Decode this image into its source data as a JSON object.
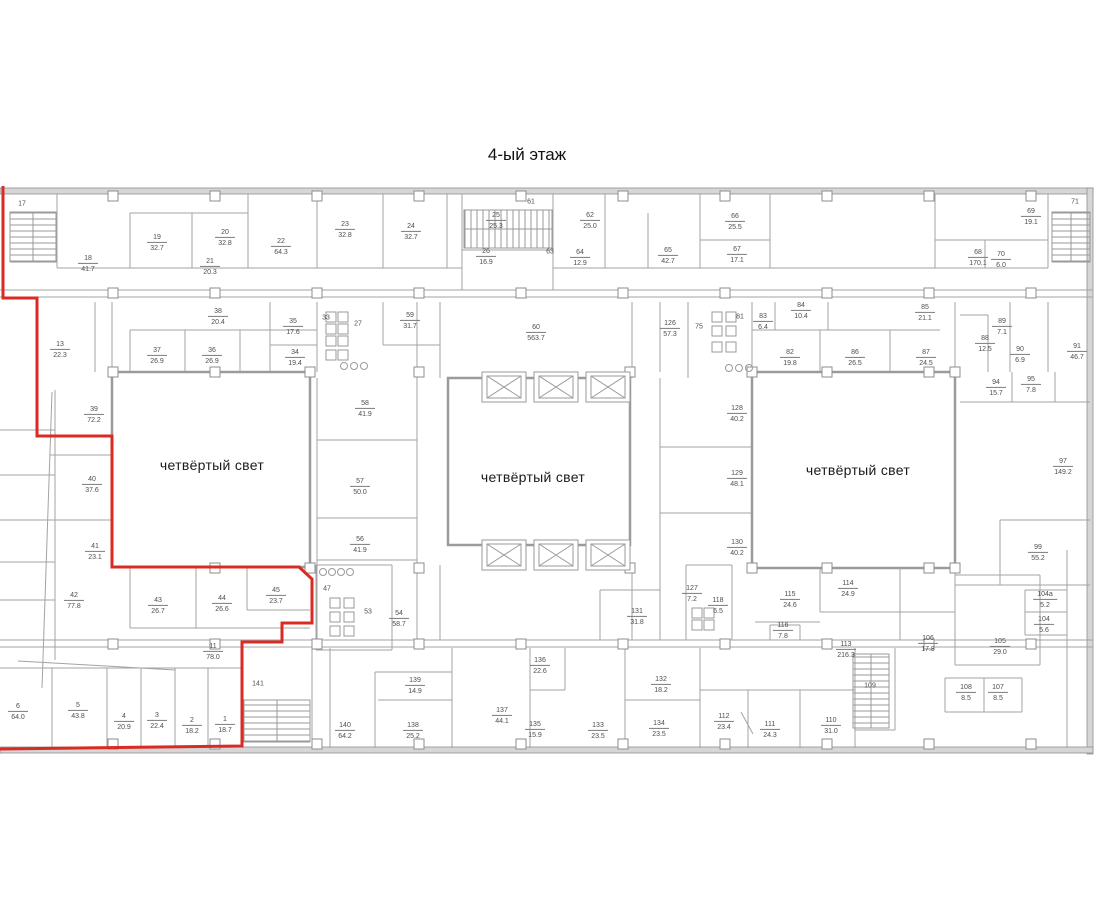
{
  "title": "4-ый этаж",
  "atrium_label": "четвёртый свет",
  "colors": {
    "wall": "#a3a3a3",
    "outer_wall_fill": "#d6d6d6",
    "outer_wall_stroke": "#8f8f8f",
    "atrium_wall": "#9b9b9b",
    "red_outline": "#d92b23",
    "label_text": "#4e4e4e",
    "title_text": "#111111"
  },
  "atria": [
    {
      "label_x": 212,
      "label_y": 465
    },
    {
      "label_x": 533,
      "label_y": 477
    },
    {
      "label_x": 858,
      "label_y": 470
    }
  ],
  "red_outline": {
    "points": [
      [
        3,
        186
      ],
      [
        3,
        298
      ],
      [
        37,
        298
      ],
      [
        37,
        436
      ],
      [
        112,
        436
      ],
      [
        112,
        567
      ],
      [
        299,
        567
      ],
      [
        312,
        579
      ],
      [
        312,
        623
      ],
      [
        282,
        623
      ],
      [
        282,
        642
      ],
      [
        242,
        642
      ],
      [
        242,
        746
      ],
      [
        0,
        749
      ]
    ]
  },
  "rooms": [
    {
      "n": "17",
      "a": "",
      "x": 22,
      "y": 204
    },
    {
      "n": "18",
      "a": "41.7",
      "x": 88,
      "y": 264
    },
    {
      "n": "19",
      "a": "32.7",
      "x": 157,
      "y": 243
    },
    {
      "n": "20",
      "a": "32.8",
      "x": 225,
      "y": 238
    },
    {
      "n": "21",
      "a": "20.3",
      "x": 210,
      "y": 267
    },
    {
      "n": "22",
      "a": "64.3",
      "x": 281,
      "y": 247
    },
    {
      "n": "23",
      "a": "32.8",
      "x": 345,
      "y": 230
    },
    {
      "n": "24",
      "a": "32.7",
      "x": 411,
      "y": 232
    },
    {
      "n": "25",
      "a": "25.3",
      "x": 496,
      "y": 221
    },
    {
      "n": "61",
      "a": "",
      "x": 531,
      "y": 202
    },
    {
      "n": "26",
      "a": "16.9",
      "x": 486,
      "y": 257
    },
    {
      "n": "63",
      "a": "",
      "x": 550,
      "y": 252
    },
    {
      "n": "62",
      "a": "25.0",
      "x": 590,
      "y": 221
    },
    {
      "n": "64",
      "a": "12.9",
      "x": 580,
      "y": 258
    },
    {
      "n": "65",
      "a": "42.7",
      "x": 668,
      "y": 256
    },
    {
      "n": "66",
      "a": "25.5",
      "x": 735,
      "y": 222
    },
    {
      "n": "67",
      "a": "17.1",
      "x": 737,
      "y": 255
    },
    {
      "n": "68",
      "a": "170.1",
      "x": 978,
      "y": 258
    },
    {
      "n": "69",
      "a": "19.1",
      "x": 1031,
      "y": 217
    },
    {
      "n": "70",
      "a": "6.0",
      "x": 1001,
      "y": 260
    },
    {
      "n": "71",
      "a": "",
      "x": 1075,
      "y": 202
    },
    {
      "n": "13",
      "a": "22.3",
      "x": 60,
      "y": 350
    },
    {
      "n": "38",
      "a": "20.4",
      "x": 218,
      "y": 317
    },
    {
      "n": "37",
      "a": "26.9",
      "x": 157,
      "y": 356
    },
    {
      "n": "36",
      "a": "26.9",
      "x": 212,
      "y": 356
    },
    {
      "n": "35",
      "a": "17.6",
      "x": 293,
      "y": 327
    },
    {
      "n": "34",
      "a": "19.4",
      "x": 295,
      "y": 358
    },
    {
      "n": "33",
      "a": "",
      "x": 326,
      "y": 318
    },
    {
      "n": "27",
      "a": "",
      "x": 358,
      "y": 324
    },
    {
      "n": "59",
      "a": "31.7",
      "x": 410,
      "y": 321
    },
    {
      "n": "60",
      "a": "563.7",
      "x": 536,
      "y": 333
    },
    {
      "n": "126",
      "a": "57.3",
      "x": 670,
      "y": 329
    },
    {
      "n": "75",
      "a": "",
      "x": 699,
      "y": 327
    },
    {
      "n": "81",
      "a": "",
      "x": 740,
      "y": 317
    },
    {
      "n": "83",
      "a": "6.4",
      "x": 763,
      "y": 322
    },
    {
      "n": "84",
      "a": "10.4",
      "x": 801,
      "y": 311
    },
    {
      "n": "85",
      "a": "21.1",
      "x": 925,
      "y": 313
    },
    {
      "n": "82",
      "a": "19.8",
      "x": 790,
      "y": 358
    },
    {
      "n": "86",
      "a": "26.5",
      "x": 855,
      "y": 358
    },
    {
      "n": "87",
      "a": "24.5",
      "x": 926,
      "y": 358
    },
    {
      "n": "88",
      "a": "12.5",
      "x": 985,
      "y": 344
    },
    {
      "n": "89",
      "a": "7.1",
      "x": 1002,
      "y": 327
    },
    {
      "n": "90",
      "a": "6.9",
      "x": 1020,
      "y": 355
    },
    {
      "n": "91",
      "a": "46.7",
      "x": 1077,
      "y": 352
    },
    {
      "n": "94",
      "a": "15.7",
      "x": 996,
      "y": 388
    },
    {
      "n": "95",
      "a": "7.8",
      "x": 1031,
      "y": 385
    },
    {
      "n": "39",
      "a": "72.2",
      "x": 94,
      "y": 415
    },
    {
      "n": "40",
      "a": "37.6",
      "x": 92,
      "y": 485
    },
    {
      "n": "41",
      "a": "23.1",
      "x": 95,
      "y": 552
    },
    {
      "n": "58",
      "a": "41.9",
      "x": 365,
      "y": 409
    },
    {
      "n": "57",
      "a": "50.0",
      "x": 360,
      "y": 487
    },
    {
      "n": "56",
      "a": "41.9",
      "x": 360,
      "y": 545
    },
    {
      "n": "128",
      "a": "40.2",
      "x": 737,
      "y": 414
    },
    {
      "n": "129",
      "a": "48.1",
      "x": 737,
      "y": 479
    },
    {
      "n": "130",
      "a": "40.2",
      "x": 737,
      "y": 548
    },
    {
      "n": "97",
      "a": "149.2",
      "x": 1063,
      "y": 467
    },
    {
      "n": "99",
      "a": "55.2",
      "x": 1038,
      "y": 553
    },
    {
      "n": "42",
      "a": "77.8",
      "x": 74,
      "y": 601
    },
    {
      "n": "43",
      "a": "26.7",
      "x": 158,
      "y": 606
    },
    {
      "n": "44",
      "a": "26.6",
      "x": 222,
      "y": 604
    },
    {
      "n": "45",
      "a": "23.7",
      "x": 276,
      "y": 596
    },
    {
      "n": "47",
      "a": "",
      "x": 327,
      "y": 589
    },
    {
      "n": "53",
      "a": "",
      "x": 368,
      "y": 612
    },
    {
      "n": "54",
      "a": "58.7",
      "x": 399,
      "y": 619
    },
    {
      "n": "11",
      "a": "78.0",
      "x": 213,
      "y": 652
    },
    {
      "n": "131",
      "a": "31.8",
      "x": 637,
      "y": 617
    },
    {
      "n": "127",
      "a": "7.2",
      "x": 692,
      "y": 594
    },
    {
      "n": "118",
      "a": "6.5",
      "x": 718,
      "y": 606
    },
    {
      "n": "116",
      "a": "7.8",
      "x": 783,
      "y": 631
    },
    {
      "n": "115",
      "a": "24.6",
      "x": 790,
      "y": 600
    },
    {
      "n": "114",
      "a": "24.9",
      "x": 848,
      "y": 589
    },
    {
      "n": "113",
      "a": "216.3",
      "x": 846,
      "y": 650
    },
    {
      "n": "136",
      "a": "22.6",
      "x": 540,
      "y": 666
    },
    {
      "n": "132",
      "a": "18.2",
      "x": 661,
      "y": 685
    },
    {
      "n": "139",
      "a": "14.9",
      "x": 415,
      "y": 686
    },
    {
      "n": "141",
      "a": "",
      "x": 258,
      "y": 684
    },
    {
      "n": "109",
      "a": "",
      "x": 870,
      "y": 686
    },
    {
      "n": "106",
      "a": "17.8",
      "x": 928,
      "y": 644
    },
    {
      "n": "105",
      "a": "29.0",
      "x": 1000,
      "y": 647
    },
    {
      "n": "104а",
      "a": "5.2",
      "x": 1045,
      "y": 600
    },
    {
      "n": "104",
      "a": "5.6",
      "x": 1044,
      "y": 625
    },
    {
      "n": "108",
      "a": "8.5",
      "x": 966,
      "y": 693
    },
    {
      "n": "107",
      "a": "8.5",
      "x": 998,
      "y": 693
    },
    {
      "n": "140",
      "a": "64.2",
      "x": 345,
      "y": 731
    },
    {
      "n": "138",
      "a": "25.2",
      "x": 413,
      "y": 731
    },
    {
      "n": "137",
      "a": "44.1",
      "x": 502,
      "y": 716
    },
    {
      "n": "135",
      "a": "15.9",
      "x": 535,
      "y": 730
    },
    {
      "n": "133",
      "a": "23.5",
      "x": 598,
      "y": 731
    },
    {
      "n": "134",
      "a": "23.5",
      "x": 659,
      "y": 729
    },
    {
      "n": "112",
      "a": "23.4",
      "x": 724,
      "y": 722
    },
    {
      "n": "111",
      "a": "24.3",
      "x": 770,
      "y": 730
    },
    {
      "n": "110",
      "a": "31.0",
      "x": 831,
      "y": 726
    },
    {
      "n": "1",
      "a": "18.7",
      "x": 225,
      "y": 725
    },
    {
      "n": "2",
      "a": "18.2",
      "x": 192,
      "y": 726
    },
    {
      "n": "3",
      "a": "22.4",
      "x": 157,
      "y": 721
    },
    {
      "n": "4",
      "a": "20.9",
      "x": 124,
      "y": 722
    },
    {
      "n": "5",
      "a": "43.8",
      "x": 78,
      "y": 711
    },
    {
      "n": "6",
      "a": "64.0",
      "x": 18,
      "y": 712
    }
  ]
}
